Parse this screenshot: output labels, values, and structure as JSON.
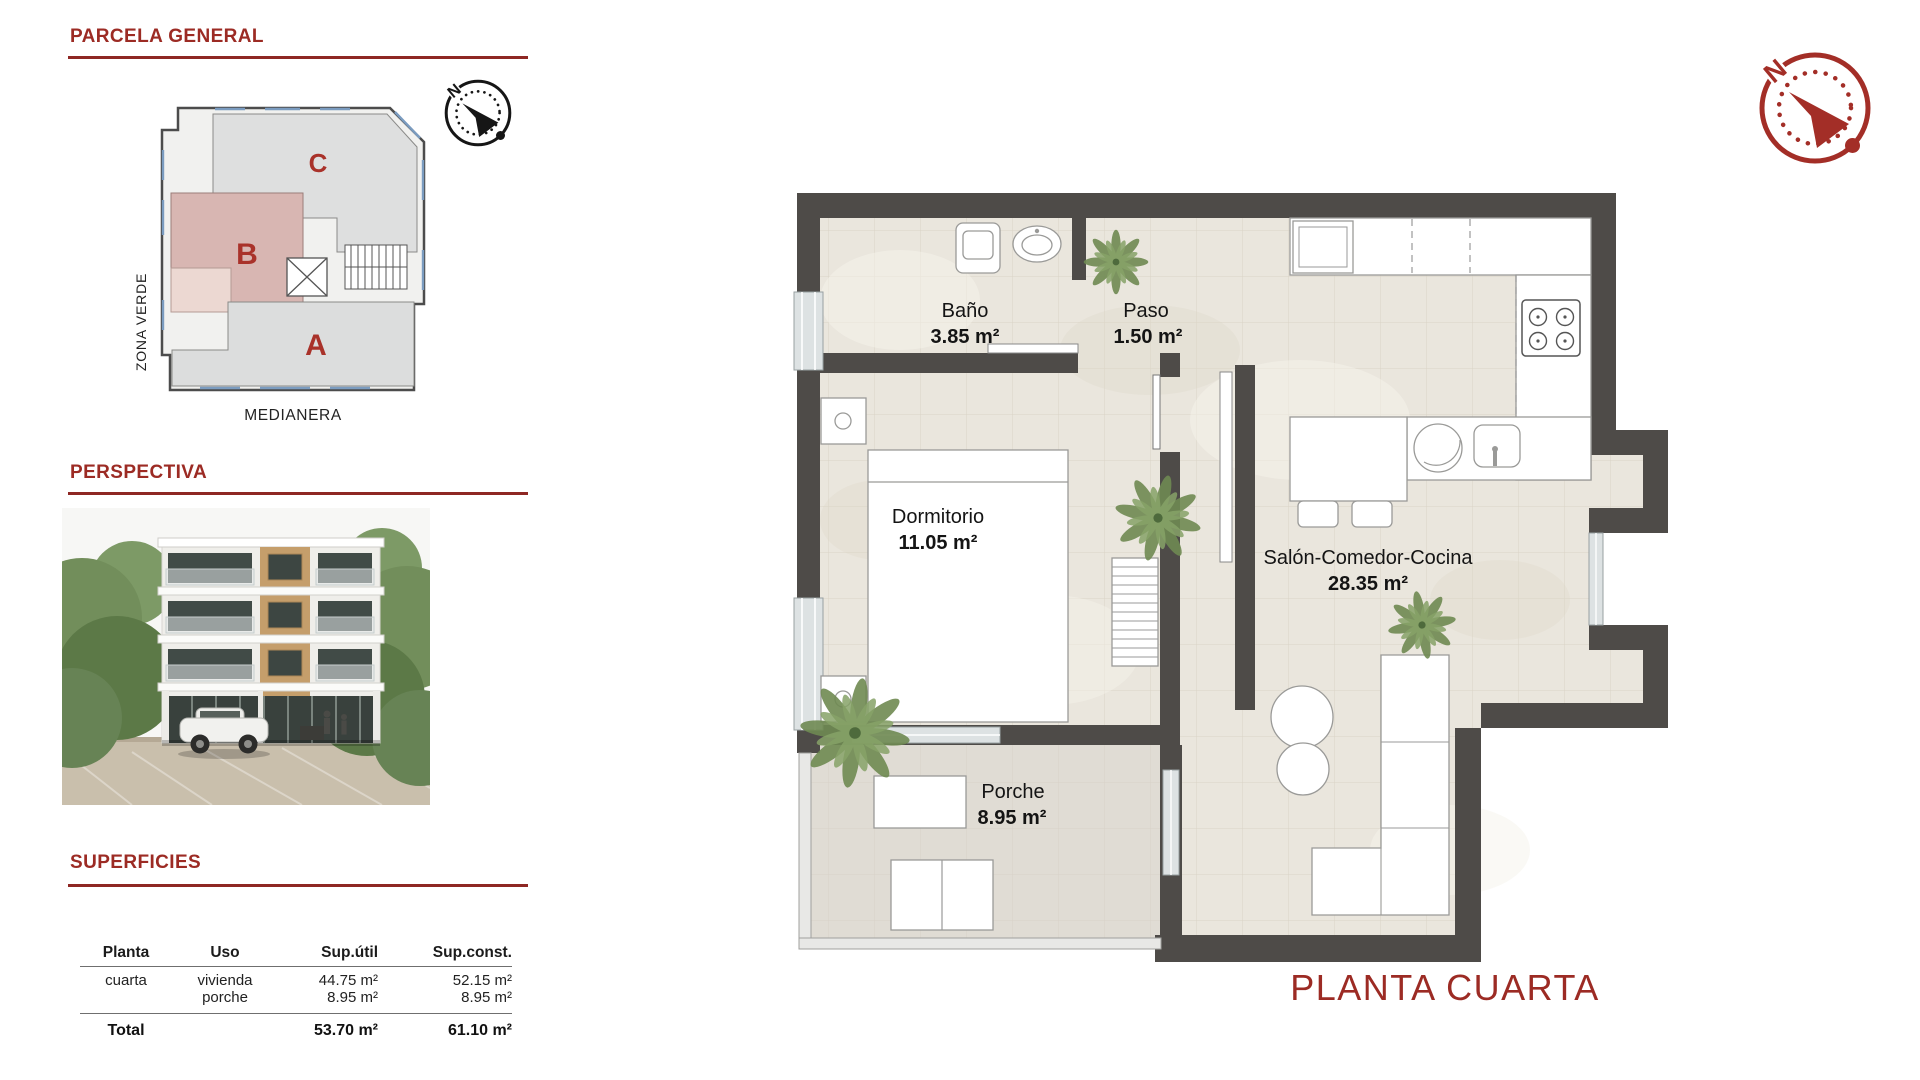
{
  "accent_color": "#9c2b24",
  "left_panel": {
    "parcela": {
      "title": "PARCELA GENERAL",
      "zone_label": "ZONA VERDE",
      "boundary_label": "MEDIANERA",
      "compass_north": "N",
      "sections": {
        "a": "A",
        "b": "B",
        "c": "C"
      }
    },
    "perspectiva": {
      "title": "PERSPECTIVA"
    },
    "superficies": {
      "title": "SUPERFICIES",
      "table": {
        "headers": [
          "Planta",
          "Uso",
          "Sup.útil",
          "Sup.const."
        ],
        "rows": [
          {
            "planta": "cuarta",
            "uso": "vivienda",
            "sup_util": "44.75 m²",
            "sup_const": "52.15 m²"
          },
          {
            "planta": "",
            "uso": "porche",
            "sup_util": "8.95 m²",
            "sup_const": "8.95 m²"
          }
        ],
        "total": {
          "label": "Total",
          "sup_util": "53.70 m²",
          "sup_const": "61.10 m²"
        }
      }
    }
  },
  "floor_plan": {
    "title": "PLANTA CUARTA",
    "compass_north": "N",
    "rooms": [
      {
        "name": "Baño",
        "area": "3.85 m²"
      },
      {
        "name": "Paso",
        "area": "1.50 m²"
      },
      {
        "name": "Dormitorio",
        "area": "11.05 m²"
      },
      {
        "name": "Salón-Comedor-Cocina",
        "area": "28.35 m²"
      },
      {
        "name": "Porche",
        "area": "8.95 m²"
      }
    ]
  }
}
